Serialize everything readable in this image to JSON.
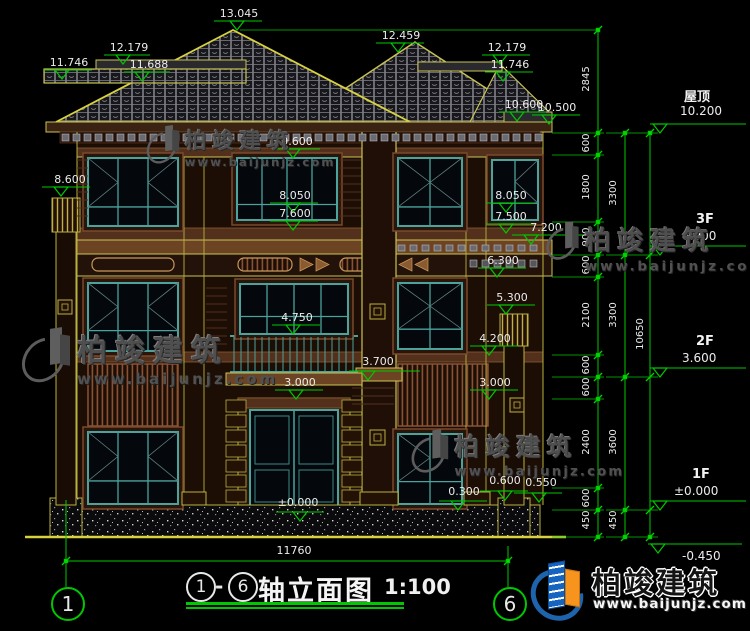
{
  "drawing": {
    "title": {
      "axis_start": "1",
      "separator": "-",
      "axis_end": "6",
      "name": "轴立面图",
      "scale": "1:100"
    },
    "axis_bubbles": {
      "left": "1",
      "right": "6"
    },
    "elevations": {
      "e13045": "13.045",
      "e12459": "12.459",
      "e12179_l": "12.179",
      "e12179_r": "12.179",
      "e11746_l": "11.746",
      "e11746_r": "11.746",
      "e11688": "11.688",
      "e10600": "10.600",
      "e10500": "10.500",
      "e9600": "9.600",
      "e8600": "8.600",
      "e8050_l": "8.050",
      "e8050_r": "8.050",
      "e7600": "7.600",
      "e7500": "7.500",
      "e7200": "7.200",
      "e6300": "6.300",
      "e5300": "5.300",
      "e4750": "4.750",
      "e4200": "4.200",
      "e3700": "3.700",
      "e3000_c": "3.000",
      "e3000_r": "3.000",
      "e0600": "0.600",
      "e0550": "0.550",
      "e0300": "0.300",
      "e0000": "±0.000",
      "em0450": "-0.450"
    },
    "floor_markers": {
      "roof_label": "屋顶",
      "roof_value": "10.200",
      "f3_label": "3F",
      "f3_value": "6.900",
      "f2_label": "2F",
      "f2_value": "3.600",
      "f1_label": "1F",
      "f1_value": "±0.000",
      "below_value": "-0.450"
    },
    "chains": {
      "inner": [
        "2845",
        "600",
        "1800",
        "900",
        "600",
        "2100",
        "600",
        "600",
        "2400",
        "600",
        "450"
      ],
      "mid": [
        "3300",
        "3300",
        "3600",
        "450"
      ],
      "total_height": "10650",
      "total_width": "11760"
    }
  },
  "watermark": {
    "name": "柏竣建筑",
    "url": "www.baijunjz.com"
  },
  "brand": {
    "name": "柏竣建筑",
    "url": "www.baijunjz.com"
  }
}
